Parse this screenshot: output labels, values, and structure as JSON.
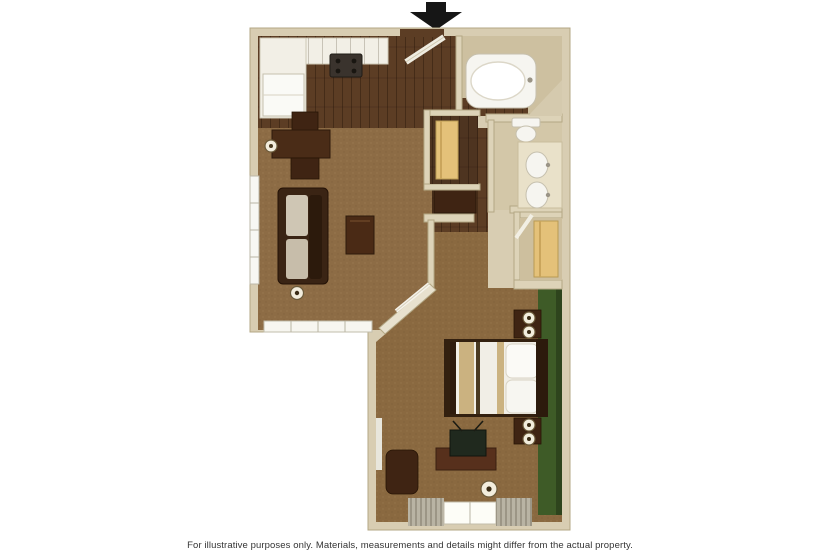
{
  "caption": {
    "text": "For illustrative purposes only.  Materials, measurements and details might differ from the actual property."
  },
  "entrance": {
    "arrow_icon": "down-arrow",
    "arrow_color": "#161616"
  },
  "colors": {
    "background": "#ffffff",
    "wall": "#d8cdb2",
    "wall_light": "#e6dfcc",
    "wood_floor": "#5c3d24",
    "carpet_living": "#8d6c45",
    "carpet_bedroom": "#8a6940",
    "green_accent_wall": "#3e5b27",
    "bath_floor": "#cdc0a0",
    "counter_white": "#f2efe6",
    "closet_shelf": "#e4c179",
    "bed_linen": "#f1eee6",
    "bed_stripe": "#cbb280"
  },
  "floorplan": {
    "type": "residential-suite-floor-plan",
    "rooms": [
      {
        "name": "kitchen"
      },
      {
        "name": "entrance-hall"
      },
      {
        "name": "bathroom-tub"
      },
      {
        "name": "vanity-toilet-room"
      },
      {
        "name": "hall-closet"
      },
      {
        "name": "wardrobe-closet"
      },
      {
        "name": "living-room"
      },
      {
        "name": "bedroom"
      }
    ],
    "furniture": [
      {
        "name": "refrigerator"
      },
      {
        "name": "kitchen-counter"
      },
      {
        "name": "stove"
      },
      {
        "name": "dining-table"
      },
      {
        "name": "dining-chairs"
      },
      {
        "name": "wall-sconce"
      },
      {
        "name": "sofa"
      },
      {
        "name": "coffee-table"
      },
      {
        "name": "floor-lamp"
      },
      {
        "name": "tv-armoire"
      },
      {
        "name": "bathtub"
      },
      {
        "name": "toilet"
      },
      {
        "name": "double-sink-vanity"
      },
      {
        "name": "closet-shelves"
      },
      {
        "name": "bed"
      },
      {
        "name": "nightstands"
      },
      {
        "name": "table-lamps"
      },
      {
        "name": "tv-desk"
      },
      {
        "name": "television"
      },
      {
        "name": "armchair"
      },
      {
        "name": "curtained-window"
      }
    ]
  }
}
